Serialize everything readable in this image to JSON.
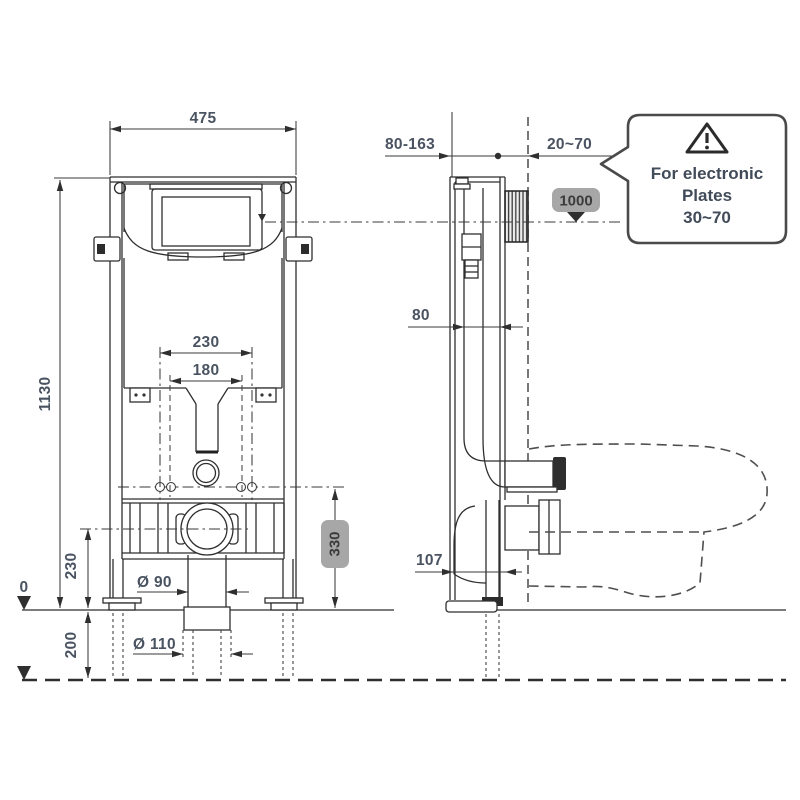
{
  "front_view": {
    "width": "475",
    "height": "1130",
    "bolt_spacing_outer": "230",
    "bolt_spacing_inner": "180",
    "outlet_height": "230",
    "below_floor_depth": "200",
    "datum_zero": "0",
    "fixing_height_badge": "330",
    "flush_pipe_dia": "Ø 90",
    "waste_pipe_dia": "Ø 110"
  },
  "side_view": {
    "install_depth_range": "80-163",
    "wall_thickness_range": "20~70",
    "frame_depth": "80",
    "outlet_offset": "107",
    "plate_height_badge": "1000"
  },
  "callout": {
    "line1": "For electronic",
    "line2": "Plates",
    "line3": "30~70"
  },
  "colors": {
    "badge_bg": "#a7a7a7",
    "badge_text": "#3c3c3c",
    "dim_text": "#4a5361",
    "line": "#2f2f2f"
  }
}
